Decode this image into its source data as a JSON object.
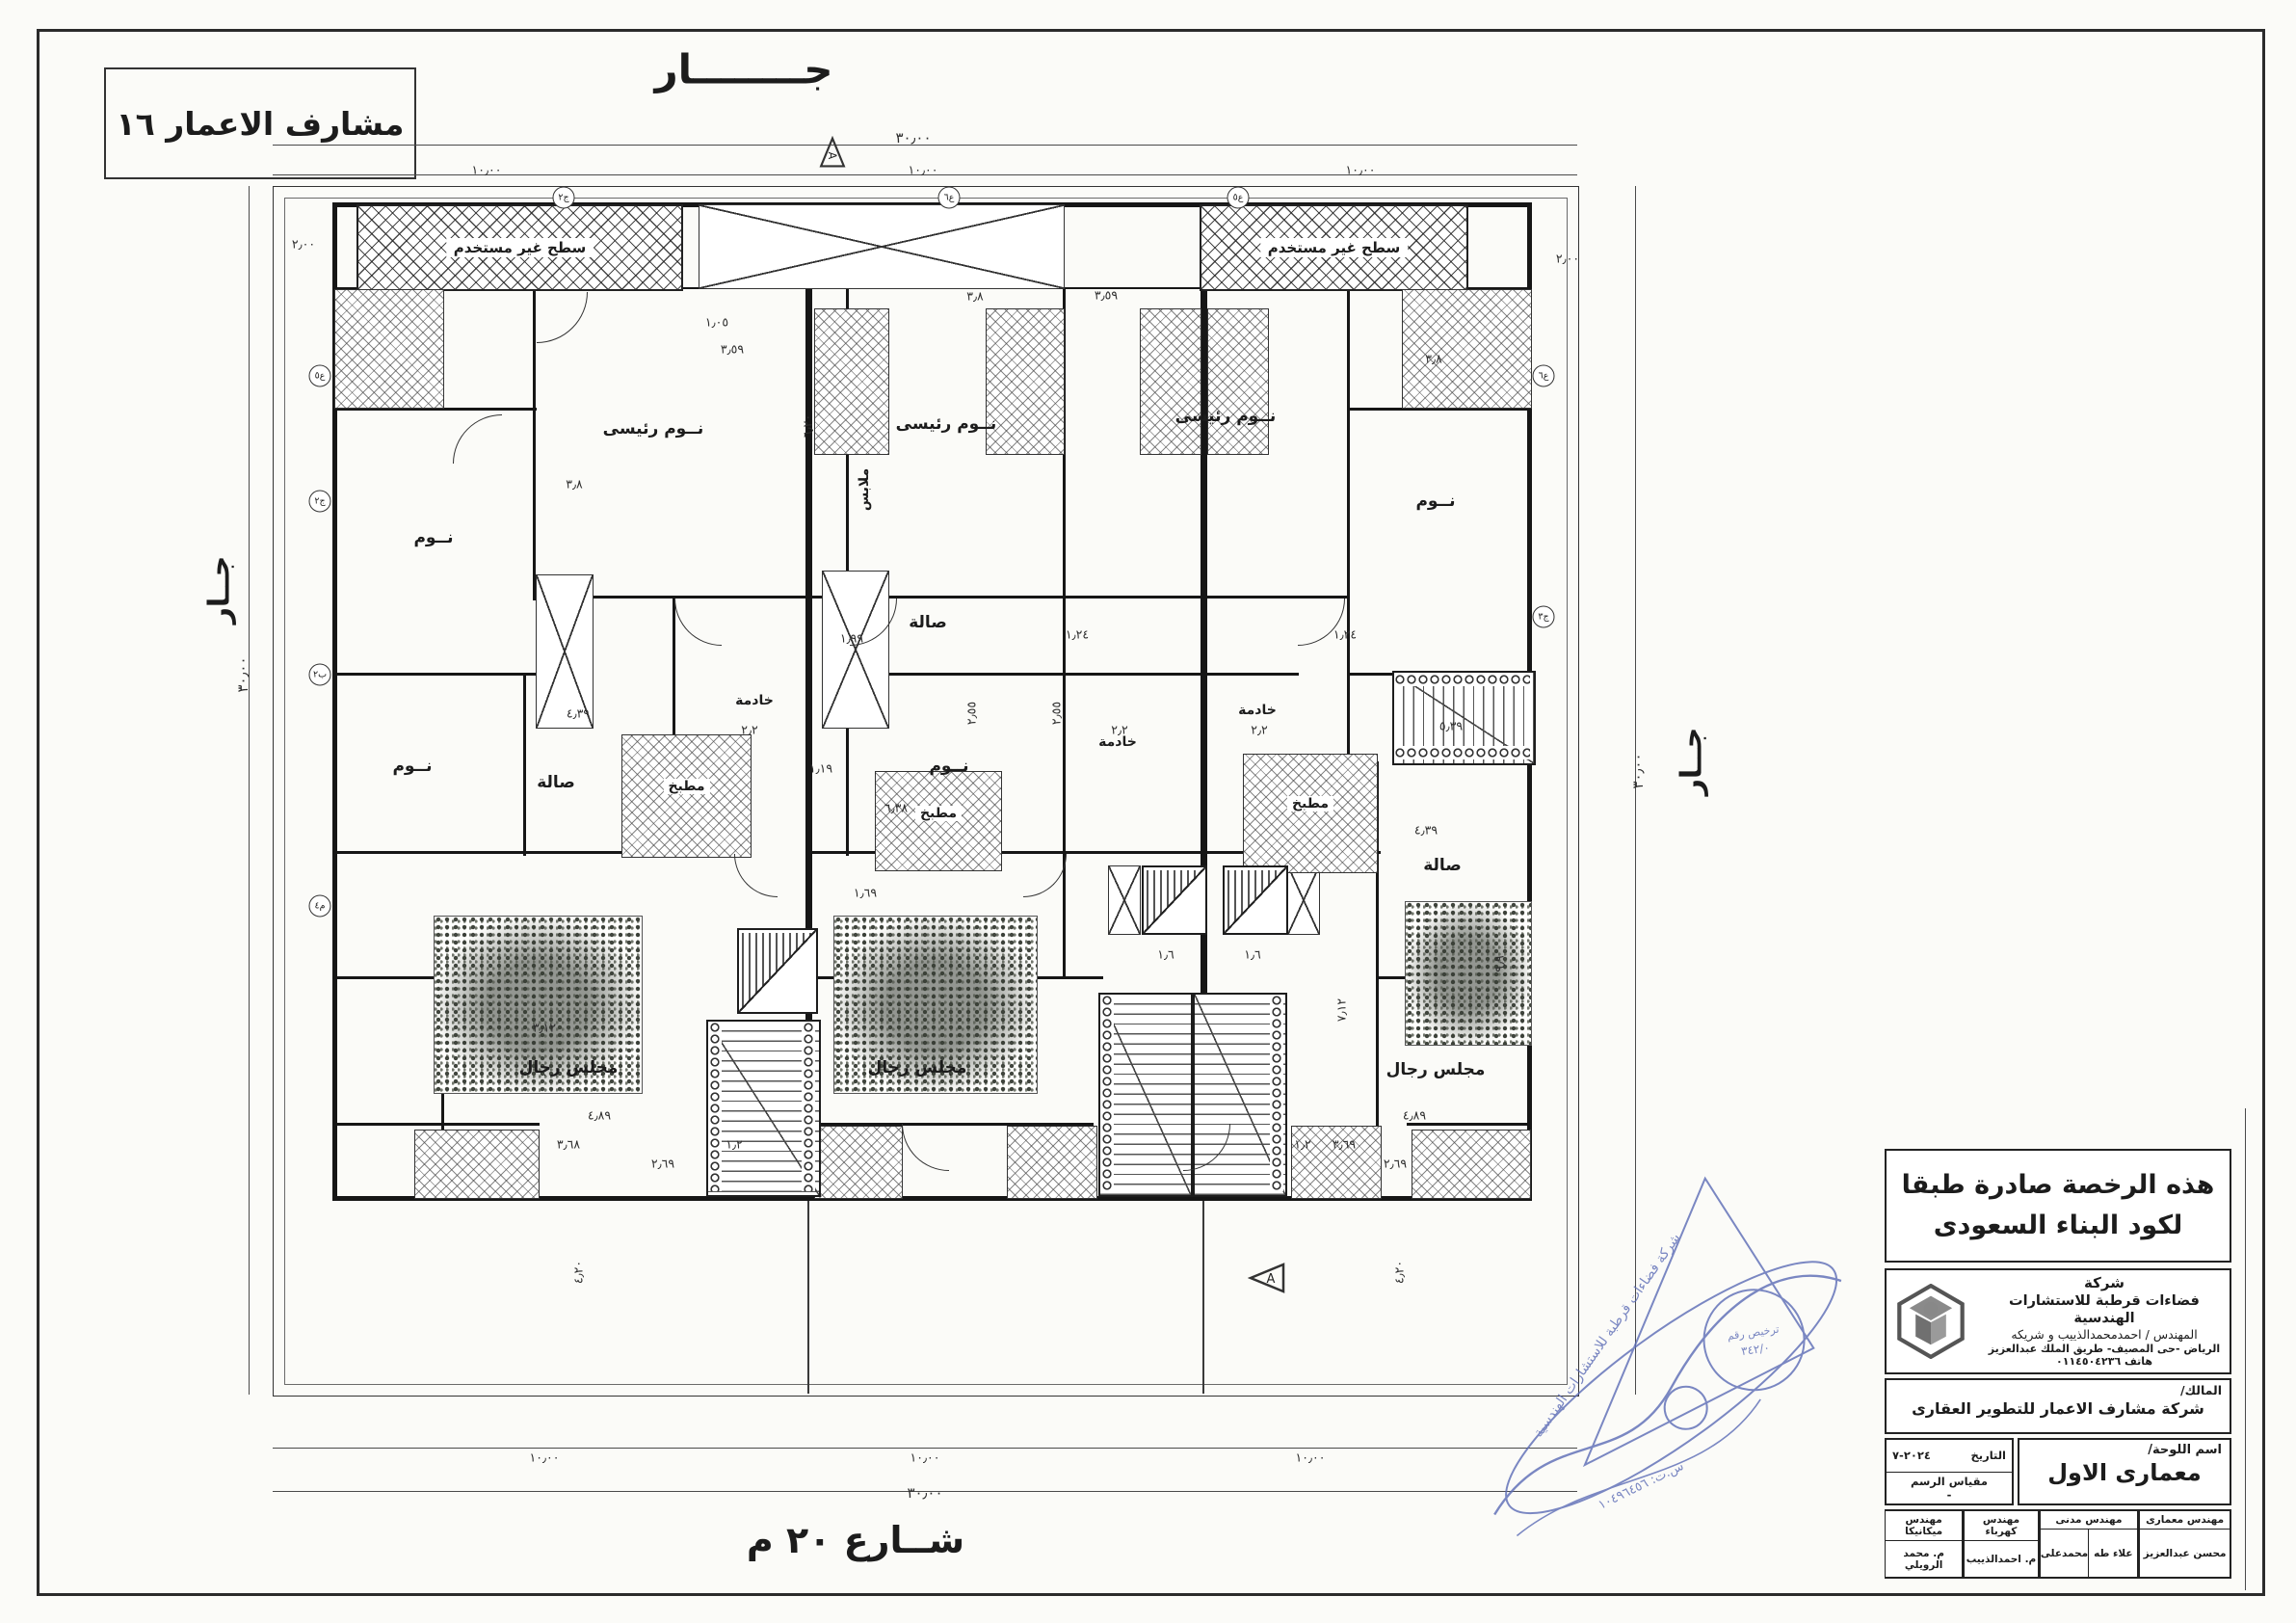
{
  "sheet": {
    "project_name": "مشارف الاعمار ١٦",
    "neighbor_top": "جــــــــار",
    "neighbor_left": "جــار",
    "neighbor_right": "جــار",
    "street": "شــارع ٢٠ م",
    "section_marker": "A"
  },
  "rooms": {
    "unused_roof": "سطح غير مستخدم",
    "master_bedroom": "نــوم رئيسى",
    "bedroom": "نــوم",
    "dressing": "ملابس",
    "maid": "خادمة",
    "hall": "صالة",
    "kitchen": "مطبخ",
    "majlis": "مجلس رجال"
  },
  "dims": {
    "d30": "٣٠٫٠٠",
    "d10": "١٠٫٠٠",
    "d2": "٢٫٠٠",
    "d3_59": "٣٫٥٩",
    "d3_8": "٣٫٨",
    "d4_39": "٤٫٣٩",
    "d6_38": "٦٫٣٨",
    "d4_89": "٤٫٨٩",
    "d3_68": "٣٫٦٨",
    "d3_69": "٣٫٦٩",
    "d2_69": "٢٫٦٩",
    "d4_20": "٤٫٢٠",
    "d1_2": "١٫٢",
    "d2_2": "٢٫٢",
    "d1_24": "١٫٢٤",
    "d5_39": "٥٫٣٩",
    "d1_99": "١٫٩٩",
    "d3_12": "٣٫١٢",
    "d1_6": "١٫٦",
    "d7_12": "٧٫١٢",
    "d9_9": "٩٫٩",
    "d2_55": "٢٫٥٥",
    "d1_05": "١٫٠٥",
    "d6_20": "٦٫٢٠",
    "d1_69": "١٫٦٩",
    "d1_19": "١٫١٩"
  },
  "wall_tags": [
    "ع٥",
    "ج٢",
    "ب٢",
    "م٤",
    "ع٦",
    "ج٣"
  ],
  "title_block": {
    "license_note_line1": "هذه الرخصة صادرة طبقا",
    "license_note_line2": "لكود البناء السعودى",
    "company": {
      "word_company": "شركة",
      "name": "فضاءات قرطبة للاستشارات الهندسية",
      "engineer": "المهندس / احمدمحمدالذييب و شريكه",
      "address": "الرياض -حى المصيف- طريق الملك عبدالعزيز",
      "phone": "هاتف ٠١١٤٥٠٤٢٣٦"
    },
    "owner_label": "المالك/",
    "owner_name": "شركة مشارف الاعمار للتطوير العقارى",
    "sheet_name_label": "اسم اللوحة/",
    "sheet_name": "معمارى الاول",
    "date_label": "التاريخ",
    "date_value": "٢٠٢٤-٧",
    "scale_label": "مقياس الرسم",
    "scale_value": "-",
    "staff": [
      {
        "role": "مهندس معمارى",
        "names": [
          "محسن عبدالعزيز"
        ]
      },
      {
        "role": "مهندس مدنى",
        "names": [
          "محمدعلى",
          "علاء طه"
        ]
      },
      {
        "role": "مهندس كهرباء",
        "names": [
          "م. احمدالذييب"
        ]
      },
      {
        "role": "مهندس ميكانيكا",
        "names": [
          "م. محمد الرويلي"
        ]
      }
    ]
  },
  "stamp": {
    "company_line": "شركة فضاءات قرطبة للاستشارات الهندسية",
    "license_label": "ترخيص رقم",
    "license_value": "٣٤٢/٠",
    "cr_line": "س.ت: ١٠٤٩٦٤٥٦"
  }
}
